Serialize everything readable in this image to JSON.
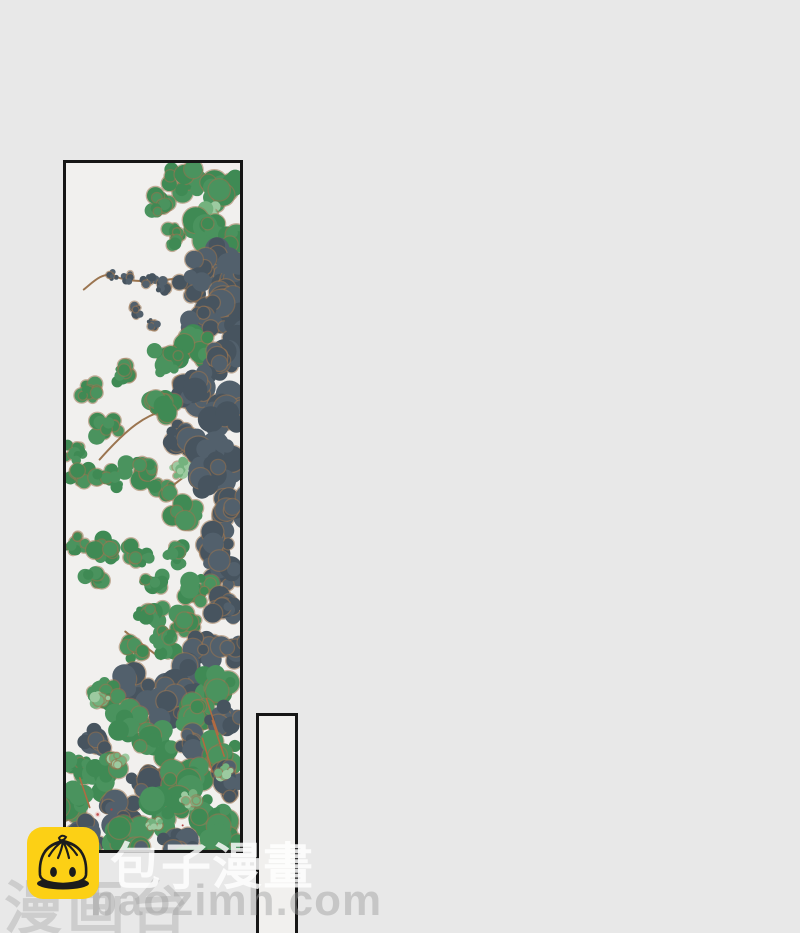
{
  "page": {
    "background": "#e8e8e8",
    "description": "comic page with tall tree-foliage panel, empty narrow panel, and reader watermarks"
  },
  "comic": {
    "panel_tall": {
      "border_color": "#161616",
      "fill": "#f1f0ee",
      "content": "tree foliage artwork"
    },
    "panel_small": {
      "border_color": "#161616",
      "fill": "#f1f0ee",
      "content": ""
    },
    "foliage_palette": {
      "dark_leaf": "#52606c",
      "dark_leaf2": "#47545f",
      "green_leaf": "#4a935e",
      "green_leaf2": "#3f8a54",
      "light_leaf": "#74b27e",
      "highlight_leaf": "#9ccaa0",
      "branch": "#9b7550",
      "twig": "#b06a42",
      "flower_petal": "#eed6d2",
      "flower_center": "#c25050",
      "speck_red": "#b04040"
    }
  },
  "watermark": {
    "brand": "包子漫畫",
    "brand_secondary": "漫画台",
    "site_url": "baozimh.com",
    "text_color_primary": "#ffffff",
    "text_color_secondary": "#c9c9c9",
    "logo": {
      "icon": "baozi-bun-icon",
      "background": "#fcd015",
      "line_color": "#1c1c1c"
    }
  }
}
